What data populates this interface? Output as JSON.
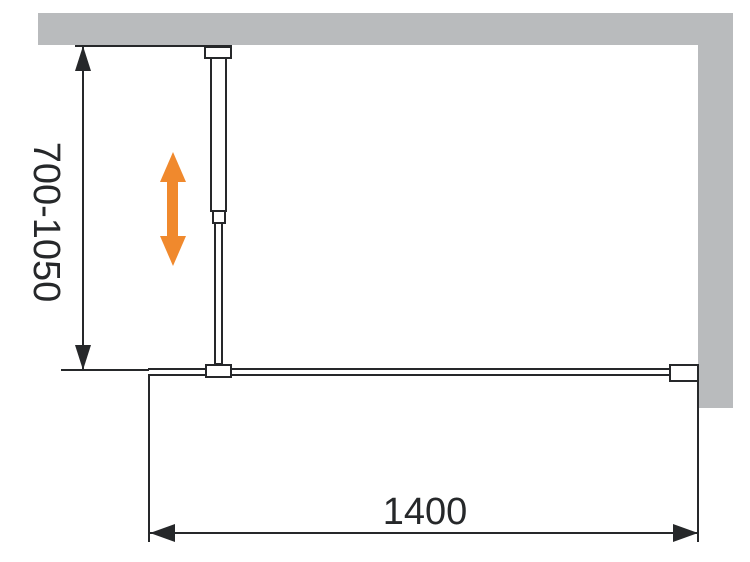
{
  "diagram": {
    "labels": {
      "height_range": "700-1050",
      "width": "1400"
    }
  },
  "colors": {
    "wall": "#B9BBBD",
    "line": "#26282A",
    "adjust_arrow": "#F0892D"
  },
  "icons": {
    "height_adjust": "vertical-double-arrow"
  }
}
